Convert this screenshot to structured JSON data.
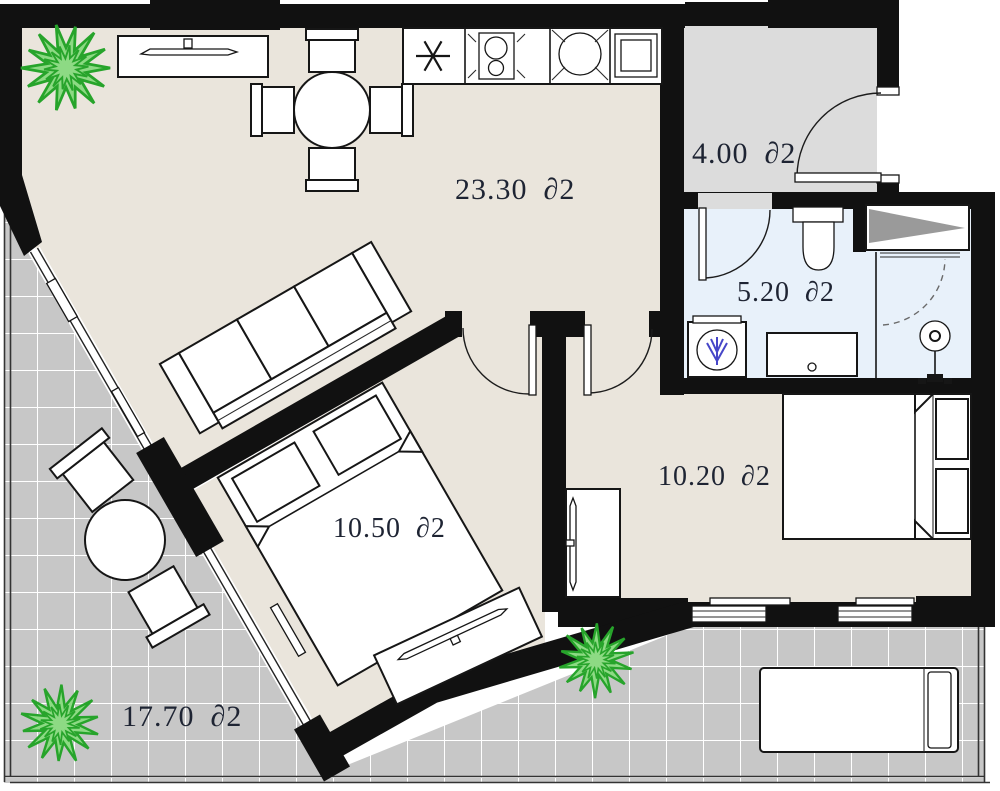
{
  "plan_title": "apartment-floor-plan",
  "rooms": {
    "living_kitchen": {
      "label": "23.30 ∂2"
    },
    "hall": {
      "label": "4.00 ∂2"
    },
    "bathroom": {
      "label": "5.20 ∂2"
    },
    "bedroom_main": {
      "label": "10.50 ∂2"
    },
    "bedroom_second": {
      "label": "10.20 ∂2"
    },
    "terrace": {
      "label": "17.70 ∂2"
    }
  },
  "colors": {
    "wall": "#111111",
    "living_floor": "#eae5dc",
    "hall_floor": "#dcdcdc",
    "bath_floor": "#e8f1fa",
    "terrace_floor": "#c7c7c7",
    "tile_line": "#ffffff",
    "niche_shade": "#9a9a9a",
    "plant_fill": "#8dda84",
    "plant_stroke": "#27a42b",
    "label_text": "#1e2433",
    "washer_accent": "#4646c8"
  }
}
